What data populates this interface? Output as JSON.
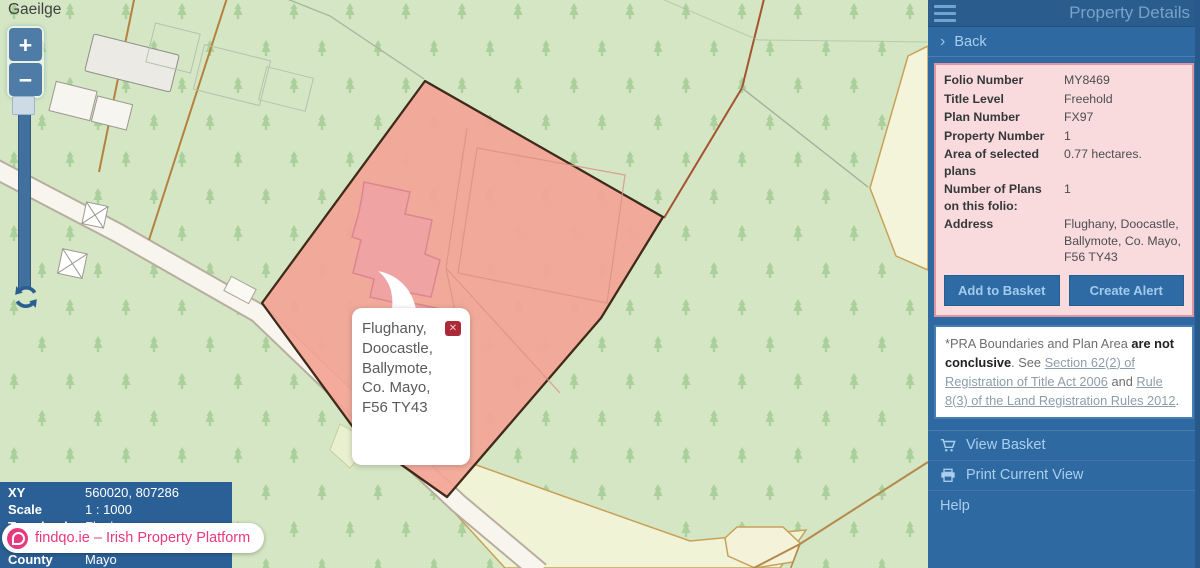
{
  "map": {
    "language_link": "Gaeilge",
    "zoom_in_label": "+",
    "zoom_out_label": "−",
    "bubble": {
      "address_text": "Flughany,\nDoocastle,\nBallymote,\nCo. Mayo,\nF56 TY43"
    },
    "info_panel": {
      "rows": [
        {
          "label": "XY",
          "value": "560020, 807286"
        },
        {
          "label": "Scale",
          "value": "1 : 1000"
        },
        {
          "label": "Townland",
          "value": "Flughany"
        },
        {
          "label": "County",
          "value": "Mayo"
        }
      ]
    },
    "badge": {
      "text": "findqo.ie – Irish Property Platform"
    }
  },
  "sidebar": {
    "title": "Property Details",
    "back_chevron": "›",
    "back_label": "Back",
    "details": {
      "rows": [
        {
          "label": "Folio Number",
          "value": "MY8469"
        },
        {
          "label": "Title Level",
          "value": "Freehold"
        },
        {
          "label": "Plan Number",
          "value": "FX97"
        },
        {
          "label": "Property Number",
          "value": "1"
        },
        {
          "label": "Area of selected plans",
          "value": "0.77 hectares."
        },
        {
          "label": "Number of Plans on this folio:",
          "value": "1"
        },
        {
          "label": "Address",
          "value": "Flughany, Doocastle, Ballymote, Co. Mayo, F56 TY43"
        }
      ],
      "add_to_basket_label": "Add to Basket",
      "create_alert_label": "Create Alert"
    },
    "disclaimer": {
      "prefix": "*PRA Boundaries and Plan Area ",
      "bold": "are not conclusive",
      "mid": ". See ",
      "link1": "Section 62(2) of Registration of Title Act 2006",
      "and_text": " and ",
      "link2": "Rule 8(3) of the Land Registration Rules 2012",
      "suffix": "."
    },
    "menu": [
      {
        "label": "View Basket"
      },
      {
        "label": "Print Current View"
      },
      {
        "label": "Help"
      }
    ]
  },
  "icons": {
    "close": "✕"
  },
  "colors": {
    "sidebar_blue": "#2f69a2",
    "header_blue": "#2a5c8e",
    "panel_pink": "#f9dadd",
    "panel_pink_border": "#df96a2",
    "property_fill": "#f3a596",
    "map_green": "#d4e6c3",
    "accent_pink": "#e6397e",
    "link_text_blue": "#a9cfec"
  }
}
